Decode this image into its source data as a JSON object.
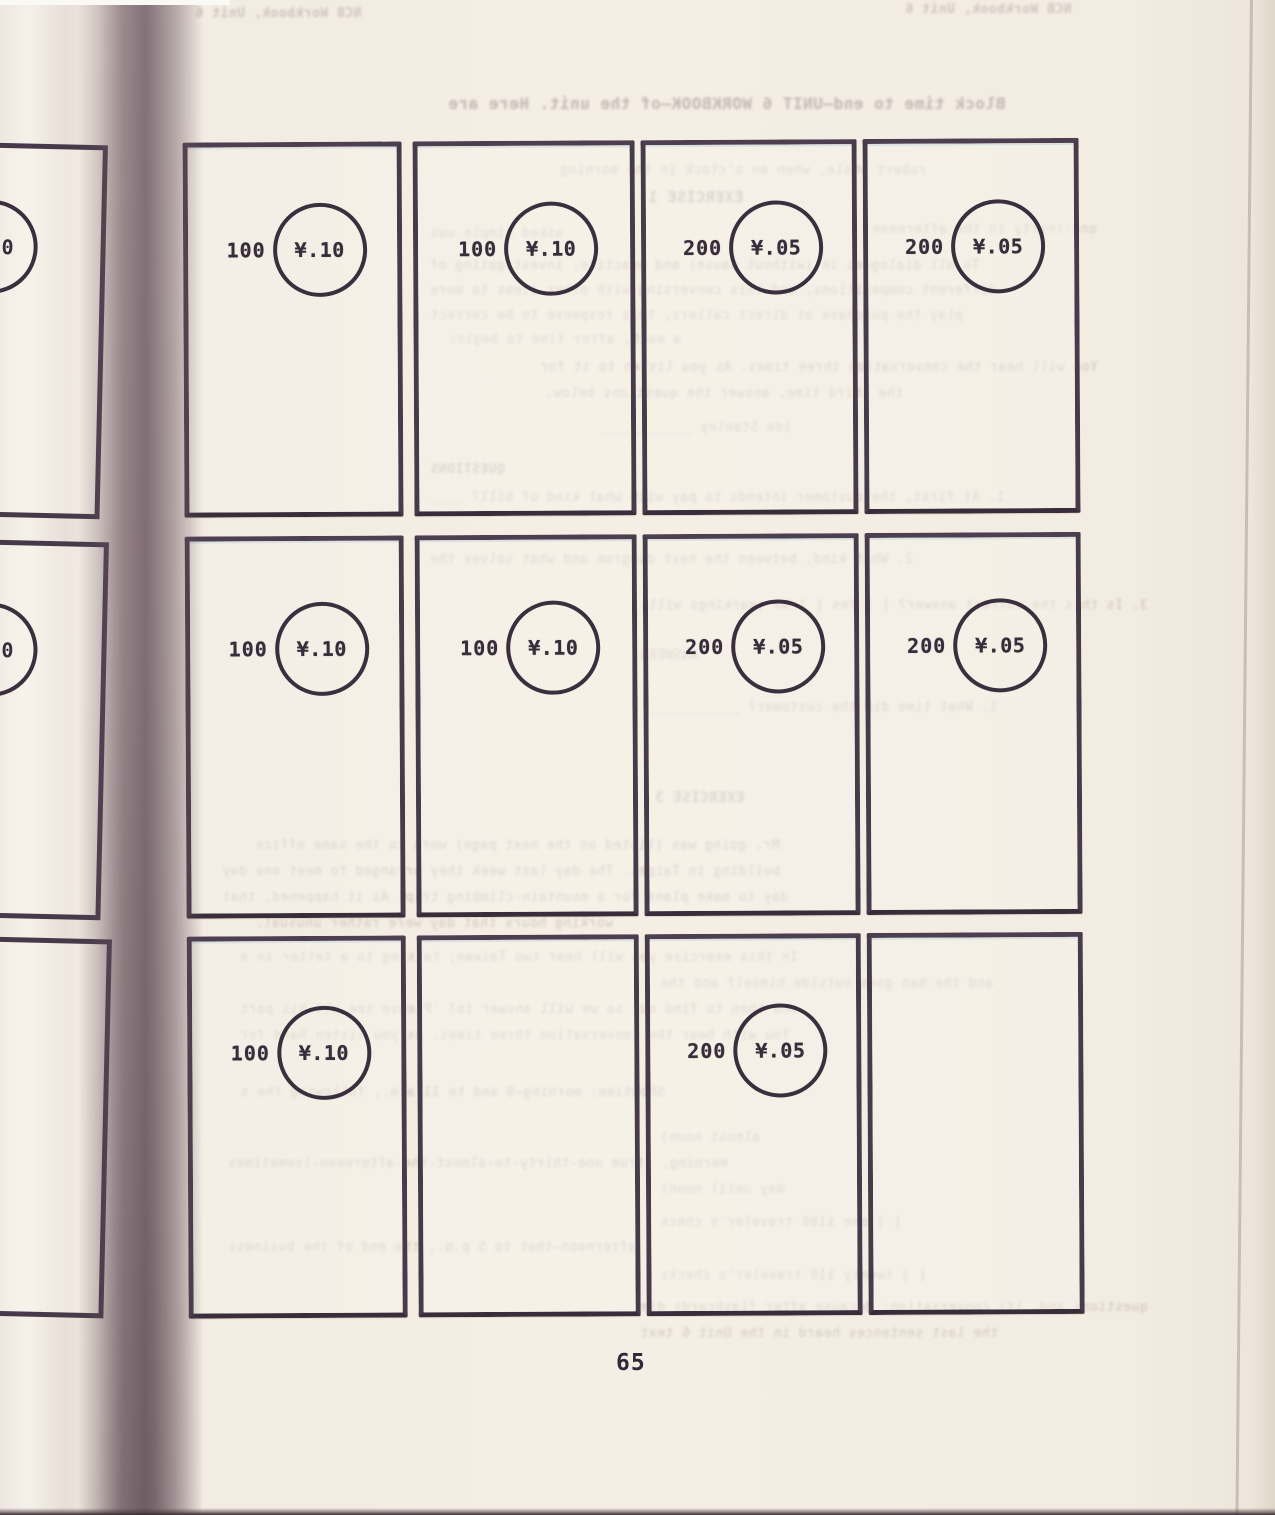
{
  "page": {
    "number": "65"
  },
  "cards": {
    "rows": [
      {
        "cells": [
          {
            "count": "100",
            "value": "¥.10"
          },
          {
            "count": "100",
            "value": "¥.10"
          },
          {
            "count": "200",
            "value": "¥.05"
          },
          {
            "count": "200",
            "value": "¥.05"
          }
        ]
      },
      {
        "cells": [
          {
            "count": "100",
            "value": "¥.10"
          },
          {
            "count": "100",
            "value": "¥.10"
          },
          {
            "count": "200",
            "value": "¥.05"
          },
          {
            "count": "200",
            "value": "¥.05"
          }
        ]
      },
      {
        "cells": [
          {
            "count": "100",
            "value": "¥.10"
          },
          {
            "count": "",
            "value": ""
          },
          {
            "count": "200",
            "value": "¥.05"
          },
          {
            "count": "",
            "value": ""
          }
        ]
      }
    ]
  },
  "left_page": {
    "fragments": [
      {
        "visible_fragment": "0"
      },
      {
        "visible_fragment": "0"
      }
    ]
  },
  "bleedthrough": {
    "note": "illegible mirrored typewriter text showing through from the reverse side of the page",
    "lines": [
      {
        "text": "NCB Workbook, Unit 6"
      },
      {
        "text": "NCB Workbook, Unit 6"
      },
      {
        "text": "Block time to end—UNIT 6 WORKBOOK—of the unit.  Here are"
      },
      {
        "text": "robert whole, when      an o'clock in the morning"
      },
      {
        "text": "EXERCISE 1"
      },
      {
        "text": "asked simple was"
      },
      {
        "text": "one-thirty in the afternoon"
      },
      {
        "text": "To all dialogues in (without pause) and practice, investigating of"
      },
      {
        "text": "different compositions, and this conversing with other items to more"
      },
      {
        "text": "play the purchase at direct callers, this response to be correct"
      },
      {
        "text": "a each, after time to begin:"
      },
      {
        "text": "You will hear the conversation three times.  As you listen to it for"
      },
      {
        "text": "the third time, answer the questions below."
      },
      {
        "text": "ide Stanley ___________"
      },
      {
        "text": "QUESTIONS"
      },
      {
        "text": "1.  At first, the customer intends to pay with what kind of bill? ____"
      },
      {
        "text": "2.  What kind, between the next diagram and what solves the"
      },
      {
        "text": "3.  Is this the correct answer?  [ ] Yes  [ ] No  (markings will)"
      },
      {
        "text": "ANSWERS"
      },
      {
        "text": "1.  What time did the customer?   ___________"
      },
      {
        "text": "EXERCISE 3"
      },
      {
        "text": "Mr. going was (listed on the next page) work to the same office"
      },
      {
        "text": "building in Taipei.  The day last week they arranged to meet one day"
      },
      {
        "text": "day to make plans for a mountain-climbing trip.  As it happened, that"
      },
      {
        "text": "working hours that day were rather unusual."
      },
      {
        "text": "In this exercise you will hear two Taiwan; talking to a teller in a"
      },
      {
        "text": "and the man goes outside himself and the"
      },
      {
        "text": "and then to find out so we will answer to?  'Please see all his part"
      },
      {
        "text": "You with hear the conversation three times.  As you listen hard for"
      },
      {
        "text": "Showtime:     morning—9 and to 11 a.m., following the s"
      },
      {
        "text": "almost noon)"
      },
      {
        "text": "morning, (from one-thirty-to-almost-the-afternoon-(sometimes"
      },
      {
        "text": "day until noon)"
      },
      {
        "text": "[ ] one $100 traveler's check"
      },
      {
        "text": "afternoon—that to 5 p.m., the end of the business"
      },
      {
        "text": "[ ] twenty $10 traveler's checks"
      },
      {
        "text": "questions and, if) conversation; Because after flashcards dim"
      },
      {
        "text": "the last sentences heard in the Unit 6 text"
      }
    ]
  }
}
